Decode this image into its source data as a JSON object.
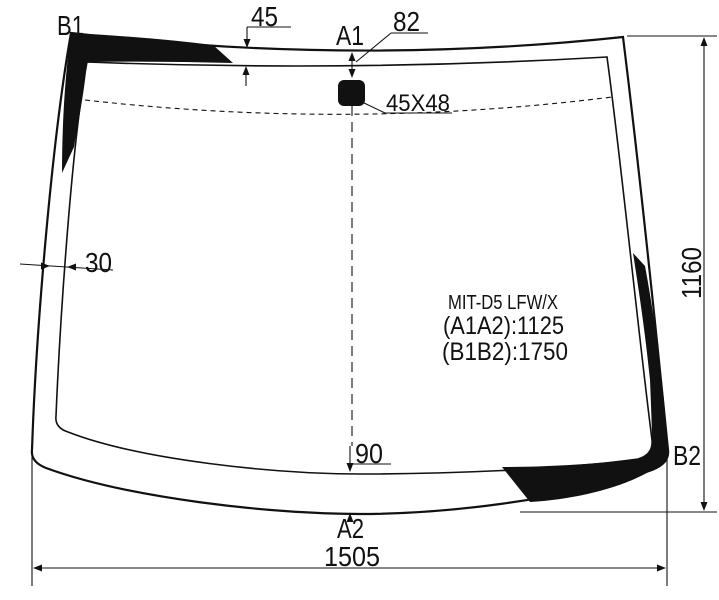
{
  "meta": {
    "background": "#ffffff",
    "ink": "#111111",
    "description": "Windscreen glass dimension drawing"
  },
  "part": {
    "code": "MIT-D5 LFW/X",
    "dim_a1a2": "(A1A2):1125",
    "dim_b1b2": "(B1B2):1750"
  },
  "point_labels": {
    "b1": "B1",
    "a1": "A1",
    "a2": "A2",
    "b2": "B2"
  },
  "measurements": {
    "top_band_width": "45",
    "mount_offset": "82",
    "mount_size": "45X48",
    "left_band_width": "30",
    "bottom_band_width": "90",
    "glass_height": "1160",
    "glass_bottom_width": "1505"
  }
}
